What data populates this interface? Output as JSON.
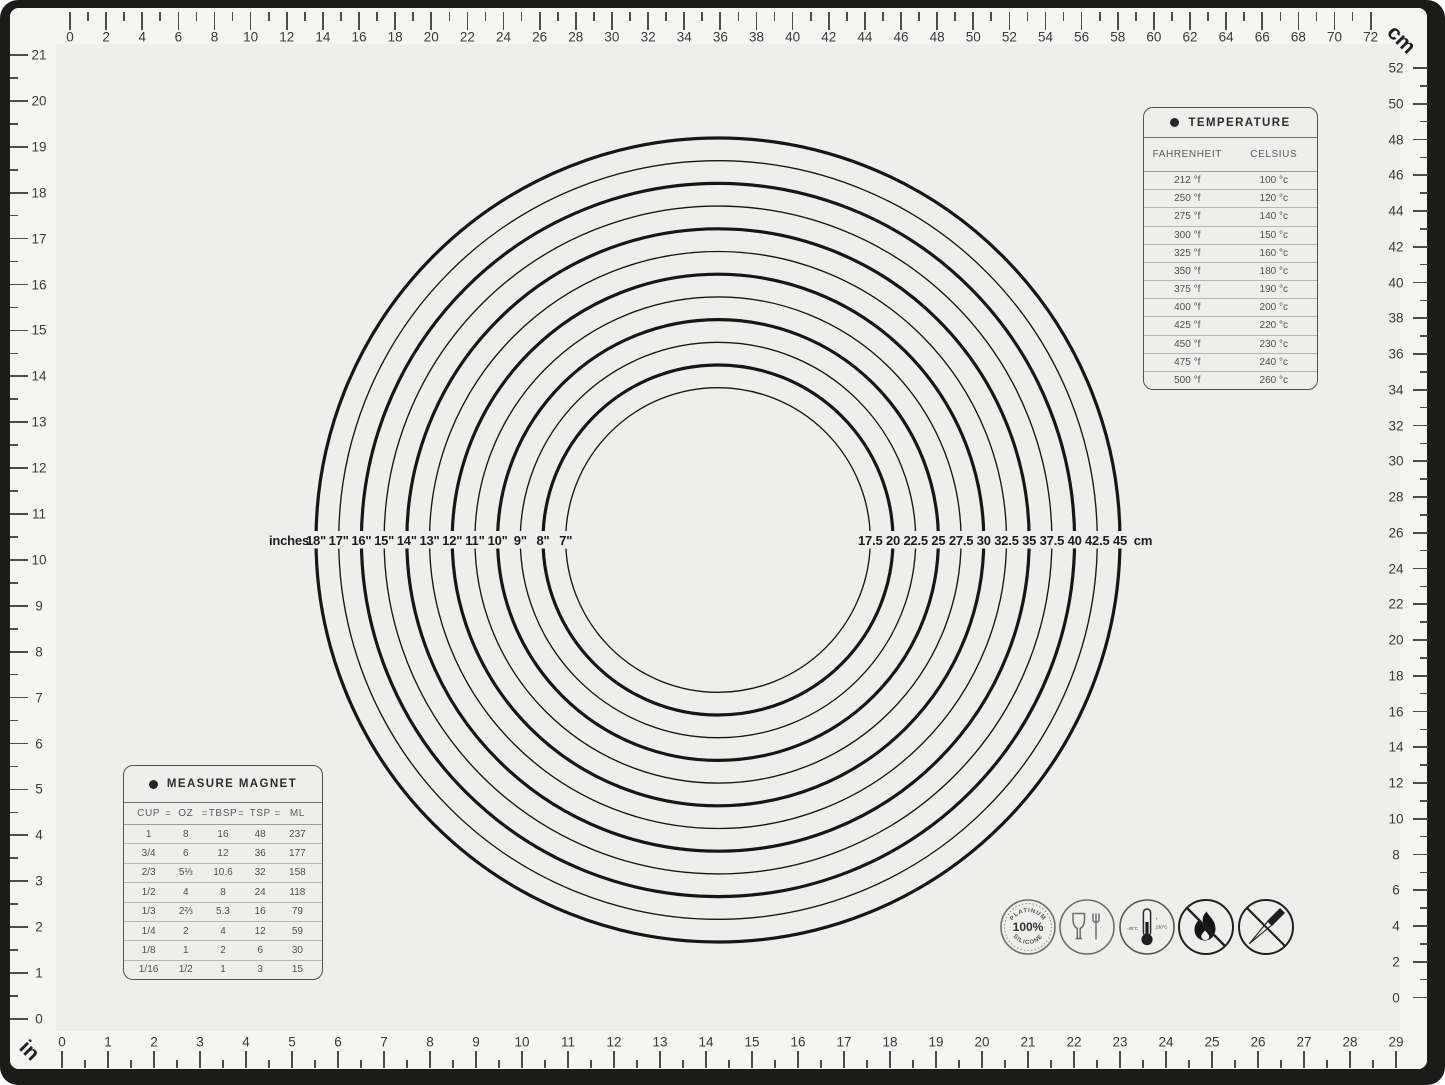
{
  "colors": {
    "mat": "#eeeeec",
    "mat_band": "#f5f5f3",
    "frame": "#1b1b19",
    "ink": "#1d1d1d"
  },
  "corner_labels": {
    "cm": "cm",
    "in": "in"
  },
  "rulers": {
    "top_cm": {
      "labels": [
        "0",
        "2",
        "4",
        "6",
        "8",
        "10",
        "12",
        "14",
        "16",
        "18",
        "20",
        "22",
        "24",
        "26",
        "28",
        "30",
        "32",
        "34",
        "36",
        "38",
        "40",
        "42",
        "44",
        "46",
        "48",
        "50",
        "52",
        "54",
        "56",
        "58",
        "60",
        "62",
        "64",
        "66",
        "68",
        "70",
        "72"
      ]
    },
    "left_in": {
      "labels": [
        "21",
        "20",
        "19",
        "18",
        "17",
        "16",
        "15",
        "14",
        "13",
        "12",
        "11",
        "10",
        "9",
        "8",
        "7",
        "6",
        "5",
        "4",
        "3",
        "2",
        "1",
        "0"
      ]
    },
    "right_cm": {
      "labels": [
        "52",
        "50",
        "48",
        "46",
        "44",
        "42",
        "40",
        "38",
        "36",
        "34",
        "32",
        "30",
        "28",
        "26",
        "24",
        "22",
        "20",
        "18",
        "16",
        "14",
        "12",
        "10",
        "8",
        "6",
        "4",
        "2",
        "0"
      ]
    },
    "bottom_in": {
      "labels": [
        "0",
        "1",
        "2",
        "3",
        "4",
        "5",
        "6",
        "7",
        "8",
        "9",
        "10",
        "11",
        "12",
        "13",
        "14",
        "15",
        "16",
        "17",
        "18",
        "19",
        "20",
        "21",
        "22",
        "23",
        "24",
        "25",
        "26",
        "27",
        "28",
        "29"
      ]
    }
  },
  "circles": {
    "left_unit_label": "inches",
    "right_unit_label": "cm",
    "rings": [
      {
        "in": "18\"",
        "cm": "45"
      },
      {
        "in": "17\"",
        "cm": "42.5"
      },
      {
        "in": "16\"",
        "cm": "40"
      },
      {
        "in": "15\"",
        "cm": "37.5"
      },
      {
        "in": "14\"",
        "cm": "35"
      },
      {
        "in": "13\"",
        "cm": "32.5"
      },
      {
        "in": "12\"",
        "cm": "30"
      },
      {
        "in": "11\"",
        "cm": "27.5"
      },
      {
        "in": "10\"",
        "cm": "25"
      },
      {
        "in": "9\"",
        "cm": "22.5"
      },
      {
        "in": "8\"",
        "cm": "20"
      },
      {
        "in": "7\"",
        "cm": "17.5"
      }
    ]
  },
  "temperature_table": {
    "title": "TEMPERATURE",
    "columns": [
      "FAHRENHEIT",
      "CELSIUS"
    ],
    "rows": [
      [
        "212 °f",
        "100 °c"
      ],
      [
        "250 °f",
        "120 °c"
      ],
      [
        "275 °f",
        "140 °c"
      ],
      [
        "300 °f",
        "150 °c"
      ],
      [
        "325 °f",
        "160 °c"
      ],
      [
        "350 °f",
        "180 °c"
      ],
      [
        "375 °f",
        "190 °c"
      ],
      [
        "400 °f",
        "200 °c"
      ],
      [
        "425 °f",
        "220 °c"
      ],
      [
        "450 °f",
        "230 °c"
      ],
      [
        "475 °f",
        "240 °c"
      ],
      [
        "500 °f",
        "260 °c"
      ]
    ]
  },
  "measure_table": {
    "title": "MEASURE MAGNET",
    "columns": [
      "CUP",
      "OZ",
      "TBSP",
      "TSP",
      "ML"
    ],
    "separator": "=",
    "rows": [
      [
        "1",
        "8",
        "16",
        "48",
        "237"
      ],
      [
        "3/4",
        "6",
        "12",
        "36",
        "177"
      ],
      [
        "2/3",
        "5⅓",
        "10.6",
        "32",
        "158"
      ],
      [
        "1/2",
        "4",
        "8",
        "24",
        "118"
      ],
      [
        "1/3",
        "2⅔",
        "5.3",
        "16",
        "79"
      ],
      [
        "1/4",
        "2",
        "4",
        "12",
        "59"
      ],
      [
        "1/8",
        "1",
        "2",
        "6",
        "30"
      ],
      [
        "1/16",
        "1/2",
        "1",
        "3",
        "15"
      ]
    ]
  },
  "icons_row": {
    "platinum": {
      "top": "PLATINUM",
      "center": "100%",
      "bottom": "SILICONE"
    },
    "temp_range": {
      "left": "-40°C",
      "plus": "+",
      "right": "230°C"
    },
    "names": [
      "platinum-100-silicone",
      "food-safe-glass-fork",
      "temperature-range",
      "no-open-flame",
      "no-sharp-objects"
    ]
  }
}
